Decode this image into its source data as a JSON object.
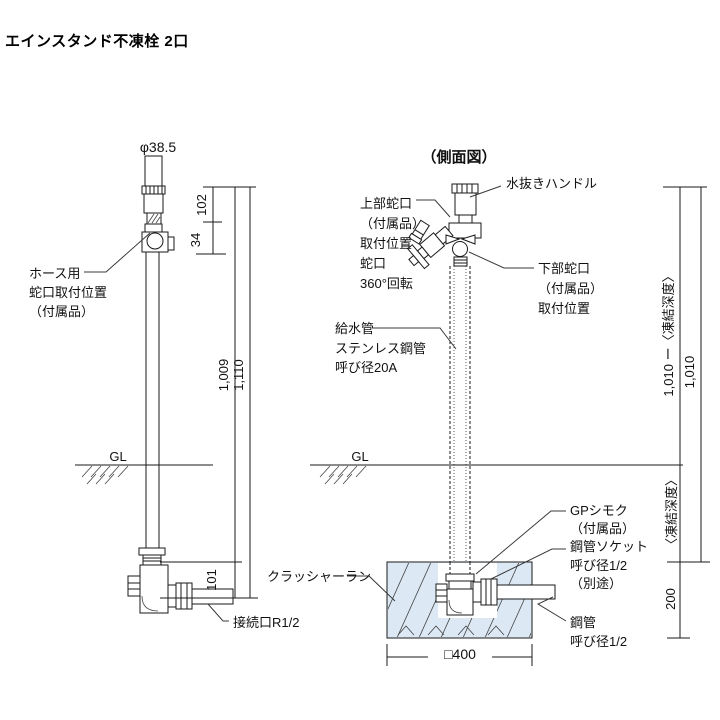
{
  "title": "エインスタンド不凍栓 2口",
  "front_view": {
    "diameter": "φ38.5",
    "hose_faucet": [
      "ホース用",
      "蛇口取付位置",
      "（付属品）"
    ],
    "gl": "GL",
    "connection": "接続口R1/2",
    "dims": {
      "top": "102",
      "faucet": "34",
      "body": "1,009",
      "total": "1,110",
      "bottom": "101"
    }
  },
  "side_view": {
    "view_title": "（側面図）",
    "drain_handle": "水抜きハンドル",
    "upper_faucet": [
      "上部蛇口",
      "（付属品）",
      "取付位置",
      "蛇口",
      "360°回転"
    ],
    "lower_faucet": [
      "下部蛇口",
      "（付属品）",
      "取付位置"
    ],
    "supply_pipe": [
      "給水管",
      "ステンレス鋼管",
      "呼び径20A"
    ],
    "gl": "GL",
    "gp_shimoku": [
      "GPシモク",
      "（付属品）"
    ],
    "pipe_socket": [
      "鋼管ソケット",
      "呼び径1/2",
      "（別途）"
    ],
    "crusher_run": "クラッシャーラン",
    "steel_pipe": [
      "鋼管",
      "呼び径1/2"
    ],
    "dims": {
      "above_ground": "1,010 ー〈凍結深度〉",
      "total": "1,010",
      "frost_depth": "〈凍結深度〉",
      "foundation": "200",
      "width": "□400"
    }
  },
  "colors": {
    "line": "#1a1a1a",
    "foundation_fill": "#dce9f5",
    "hatch": "#4a4a4a",
    "background": "#ffffff"
  }
}
